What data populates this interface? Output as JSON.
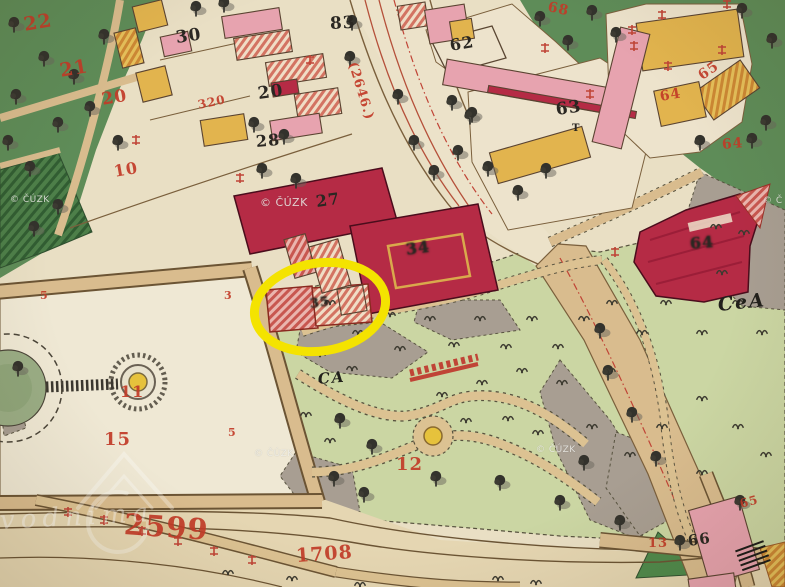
{
  "source": {
    "copyright": "© ČÚZK"
  },
  "colors": {
    "label_red": "#C23B28",
    "label_black": "#2A2722",
    "script_ink": "#21201B",
    "highlight_yellow": "#F4E300",
    "building_carmine": "#B52B45",
    "building_pink": "#E7A3AF",
    "building_ochre": "#E2B44E",
    "woodland_green": "#5E8C58",
    "park_green": "#CBD6A3",
    "road_tan": "#D9BC8E",
    "parchment": "#E9DFC4",
    "gray_terrain": "#A89E92",
    "watermark_white": "#F2F1EC"
  },
  "highlight": {
    "shape": "ellipse",
    "cx": 320,
    "cy": 307,
    "rx": 66,
    "ry": 44,
    "rotation": -9,
    "stroke": "#F4E300",
    "stroke_width": 9
  },
  "labels": [
    {
      "t": "30",
      "x": 176,
      "y": 30,
      "s": 17,
      "r": -8,
      "c": "num-black"
    },
    {
      "t": "20",
      "x": 258,
      "y": 86,
      "s": 17,
      "r": -8,
      "c": "num-black"
    },
    {
      "t": "28",
      "x": 256,
      "y": 134,
      "s": 16,
      "r": -5,
      "c": "num-black"
    },
    {
      "t": "83",
      "x": 330,
      "y": 16,
      "s": 17,
      "r": -3,
      "c": "num-black"
    },
    {
      "t": "62",
      "x": 450,
      "y": 38,
      "s": 16,
      "r": -10,
      "c": "num-black"
    },
    {
      "t": "63",
      "x": 556,
      "y": 102,
      "s": 17,
      "r": -8,
      "c": "num-black"
    },
    {
      "t": "T",
      "x": 572,
      "y": 124,
      "s": 10,
      "r": 0,
      "c": "num-black"
    },
    {
      "t": "27",
      "x": 316,
      "y": 194,
      "s": 16,
      "r": -8,
      "c": "num-black"
    },
    {
      "t": "34",
      "x": 406,
      "y": 242,
      "s": 16,
      "r": -8,
      "c": "num-black",
      "fx": "smudge"
    },
    {
      "t": "35",
      "x": 310,
      "y": 298,
      "s": 13,
      "r": -8,
      "c": "num-black",
      "fx": "smudge"
    },
    {
      "t": "64",
      "x": 690,
      "y": 236,
      "s": 16,
      "r": -5,
      "c": "num-black",
      "fx": "smudge"
    },
    {
      "t": "66",
      "x": 688,
      "y": 534,
      "s": 15,
      "r": -8,
      "c": "num-black"
    },
    {
      "t": "22",
      "x": 24,
      "y": 16,
      "s": 19,
      "r": -10,
      "c": "num-red"
    },
    {
      "t": "21",
      "x": 60,
      "y": 62,
      "s": 19,
      "r": -10,
      "c": "num-red"
    },
    {
      "t": "20",
      "x": 102,
      "y": 92,
      "s": 17,
      "r": -10,
      "c": "num-red"
    },
    {
      "t": "10",
      "x": 114,
      "y": 164,
      "s": 16,
      "r": -10,
      "c": "num-red"
    },
    {
      "t": "320",
      "x": 198,
      "y": 99,
      "s": 12,
      "r": -12,
      "c": "num-red"
    },
    {
      "t": "(2646.)",
      "x": 352,
      "y": 56,
      "s": 13,
      "r": 73,
      "c": "num-red"
    },
    {
      "t": "68",
      "x": 548,
      "y": 0,
      "s": 14,
      "r": 12,
      "c": "num-red"
    },
    {
      "t": "65",
      "x": 700,
      "y": 70,
      "s": 14,
      "r": -35,
      "c": "num-red"
    },
    {
      "t": "64",
      "x": 660,
      "y": 90,
      "s": 14,
      "r": -10,
      "c": "num-red"
    },
    {
      "t": "64",
      "x": 722,
      "y": 138,
      "s": 14,
      "r": -5,
      "c": "num-red"
    },
    {
      "t": "5",
      "x": 40,
      "y": 290,
      "s": 11,
      "r": 0,
      "c": "num-red"
    },
    {
      "t": "3",
      "x": 224,
      "y": 290,
      "s": 11,
      "r": 0,
      "c": "num-red"
    },
    {
      "t": "5",
      "x": 228,
      "y": 427,
      "s": 11,
      "r": 0,
      "c": "num-red"
    },
    {
      "t": "11",
      "x": 120,
      "y": 384,
      "s": 16,
      "r": 0,
      "c": "num-red"
    },
    {
      "t": "15",
      "x": 104,
      "y": 431,
      "s": 18,
      "r": 0,
      "c": "num-red"
    },
    {
      "t": "12",
      "x": 396,
      "y": 456,
      "s": 18,
      "r": 0,
      "c": "num-red"
    },
    {
      "t": "2599",
      "x": 124,
      "y": 510,
      "s": 29,
      "r": 4,
      "c": "num-red"
    },
    {
      "t": "1708",
      "x": 296,
      "y": 547,
      "s": 19,
      "r": -4,
      "c": "num-red"
    },
    {
      "t": "13",
      "x": 648,
      "y": 537,
      "s": 13,
      "r": 0,
      "c": "num-red"
    },
    {
      "t": "65",
      "x": 740,
      "y": 498,
      "s": 12,
      "r": -15,
      "c": "num-red"
    },
    {
      "t": "CeA",
      "x": 718,
      "y": 296,
      "s": 19,
      "r": -6,
      "c": "script"
    },
    {
      "t": "CA",
      "x": 318,
      "y": 372,
      "s": 15,
      "r": -5,
      "c": "script"
    },
    {
      "t": "© ČÚZK",
      "x": 10,
      "y": 196,
      "s": 9,
      "r": 0,
      "c": "wm"
    },
    {
      "t": "© ČÚZK",
      "x": 260,
      "y": 197,
      "s": 11,
      "r": 0,
      "c": "wm"
    },
    {
      "t": "© ČÚZK",
      "x": 254,
      "y": 450,
      "s": 9,
      "r": 0,
      "c": "wm"
    },
    {
      "t": "© ČÚZK",
      "x": 536,
      "y": 446,
      "s": 9,
      "r": 0,
      "c": "wm"
    },
    {
      "t": "© Č",
      "x": 763,
      "y": 197,
      "s": 9,
      "r": 0,
      "c": "wm"
    },
    {
      "t": "vodnima",
      "x": 0,
      "y": 508,
      "s": 26,
      "r": -3,
      "c": "wm-script"
    }
  ]
}
